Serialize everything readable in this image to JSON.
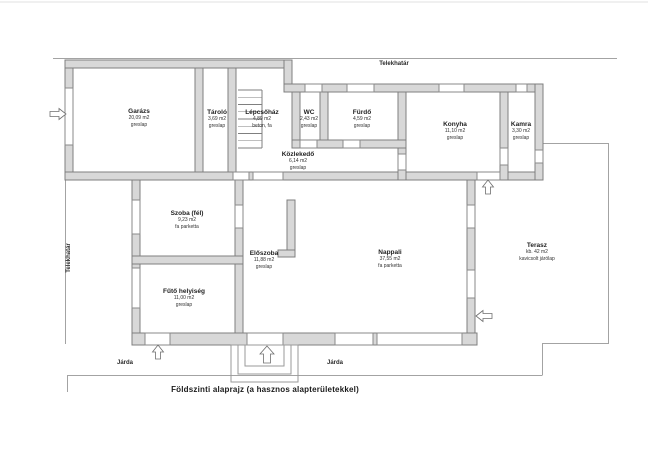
{
  "title": "Földszinti alaprajz (a hasznos alapterületekkel)",
  "boundary_labels": {
    "top": "Telekhatár",
    "left": "Telekhatár"
  },
  "sidewalk_labels": {
    "left": "Járda",
    "right": "Járda"
  },
  "rooms": [
    {
      "name": "Garázs",
      "area": "20,09 m2",
      "floor": "greslap"
    },
    {
      "name": "Tároló",
      "area": "3,69 m2",
      "floor": "greslap"
    },
    {
      "name": "Lépcsőház",
      "area": "4,89 m2",
      "floor": "beton, fa"
    },
    {
      "name": "WC",
      "area": "2,43 m2",
      "floor": "greslap"
    },
    {
      "name": "Fürdő",
      "area": "4,59 m2",
      "floor": "greslap"
    },
    {
      "name": "Konyha",
      "area": "11,10 m2",
      "floor": "greslap"
    },
    {
      "name": "Kamra",
      "area": "3,30 m2",
      "floor": "greslap"
    },
    {
      "name": "Közlekedő",
      "area": "6,14 m2",
      "floor": "greslap"
    },
    {
      "name": "Szoba (fél)",
      "area": "9,23 m2",
      "floor": "fa parketta"
    },
    {
      "name": "Előszoba",
      "area": "11,88 m2",
      "floor": "greslap"
    },
    {
      "name": "Nappali",
      "area": "37,55 m2",
      "floor": "fa parketta"
    },
    {
      "name": "Fűtő helyiség",
      "area": "11,00 m2",
      "floor": "greslap"
    },
    {
      "name": "Terasz",
      "area": "kb. 42 m2",
      "floor": "kavicsolt járólap"
    }
  ],
  "icons": {
    "garage-door-arrow": "→",
    "kitchen-back-door-arrow": "↑",
    "terrace-door-arrow": "←",
    "heating-room-door-arrow": "↑",
    "main-entrance-arrow": "↑"
  },
  "colors": {
    "wall_fill": "#d8d8d8",
    "wall_stroke": "#7f7f7f",
    "thin_line": "#a3a3a3",
    "text": "#2b2b2b"
  }
}
